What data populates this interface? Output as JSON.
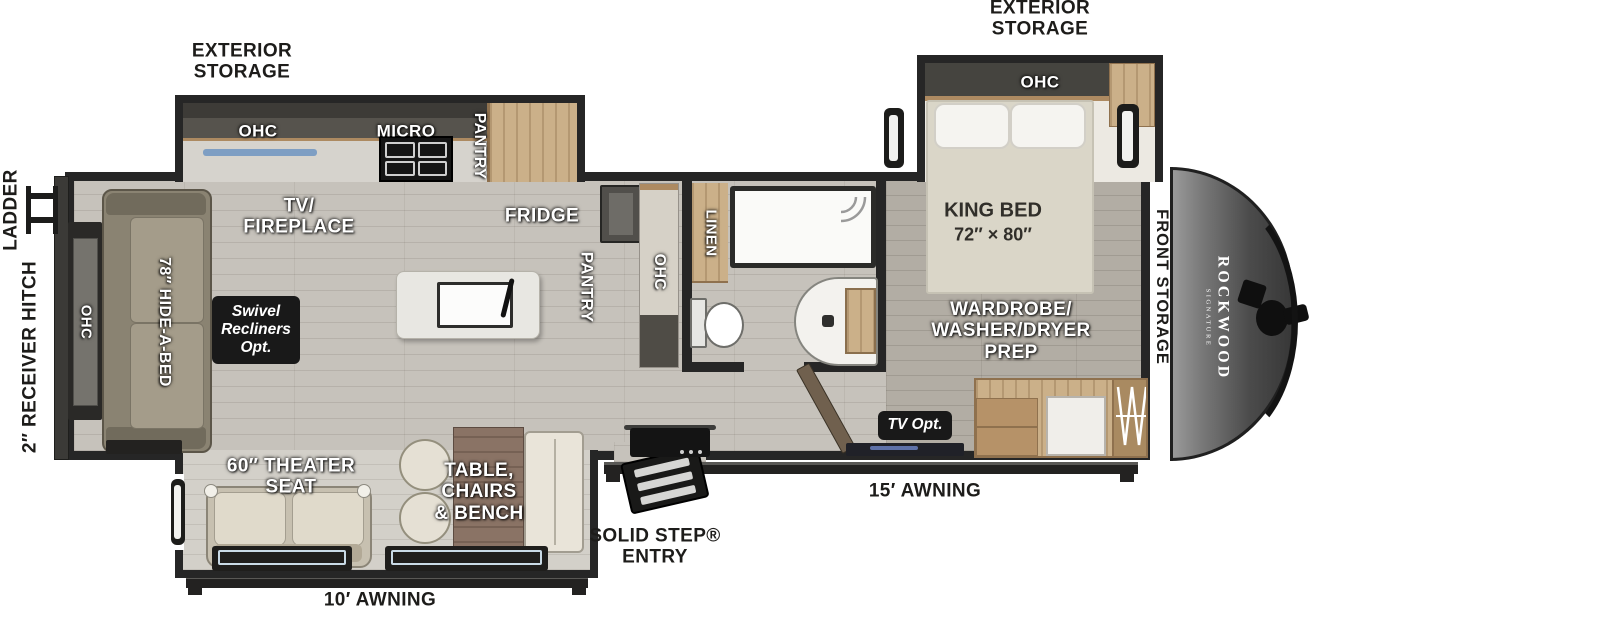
{
  "title": "Rockwood Signature travel trailer floorplan",
  "brand": {
    "name": "ROCKWOOD",
    "sub": "SIGNATURE"
  },
  "labels": {
    "exterior_storage": [
      "EXTERIOR",
      "STORAGE"
    ],
    "ladder": "LADDER",
    "receiver_hitch": "2″ RECEIVER HITCH",
    "ohc": "OHC",
    "micro": "MICRO",
    "pantry": "PANTRY",
    "tv_fireplace": [
      "TV/",
      "FIREPLACE"
    ],
    "fridge": "FRIDGE",
    "linen": "LINEN",
    "king_bed": [
      "KING BED",
      "72″ × 80″"
    ],
    "wardrobe_prep": [
      "WARDROBE/",
      "WASHER/DRYER",
      "PREP"
    ],
    "front_storage": "FRONT STORAGE",
    "hide_a_bed": "78″ HIDE-A-BED",
    "swivel_recliners": [
      "Swivel",
      "Recliners",
      "Opt."
    ],
    "theater_seat": [
      "60″ THEATER",
      "SEAT"
    ],
    "dinette": [
      "TABLE,",
      "CHAIRS",
      "& BENCH"
    ],
    "solid_step": [
      "SOLID STEP®",
      "ENTRY"
    ],
    "awning_15": "15′ AWNING",
    "awning_10": "10′ AWNING",
    "tv_opt": "TV Opt."
  },
  "colors": {
    "wall": "#262626",
    "badge": "#191919",
    "floor": "#c6c2bb",
    "bedroom_floor": "#b2ada4",
    "wood": "#cbb089",
    "counter": "#d6d3cd",
    "sofa": "#8a8372",
    "cap": "#4b4b4b"
  }
}
